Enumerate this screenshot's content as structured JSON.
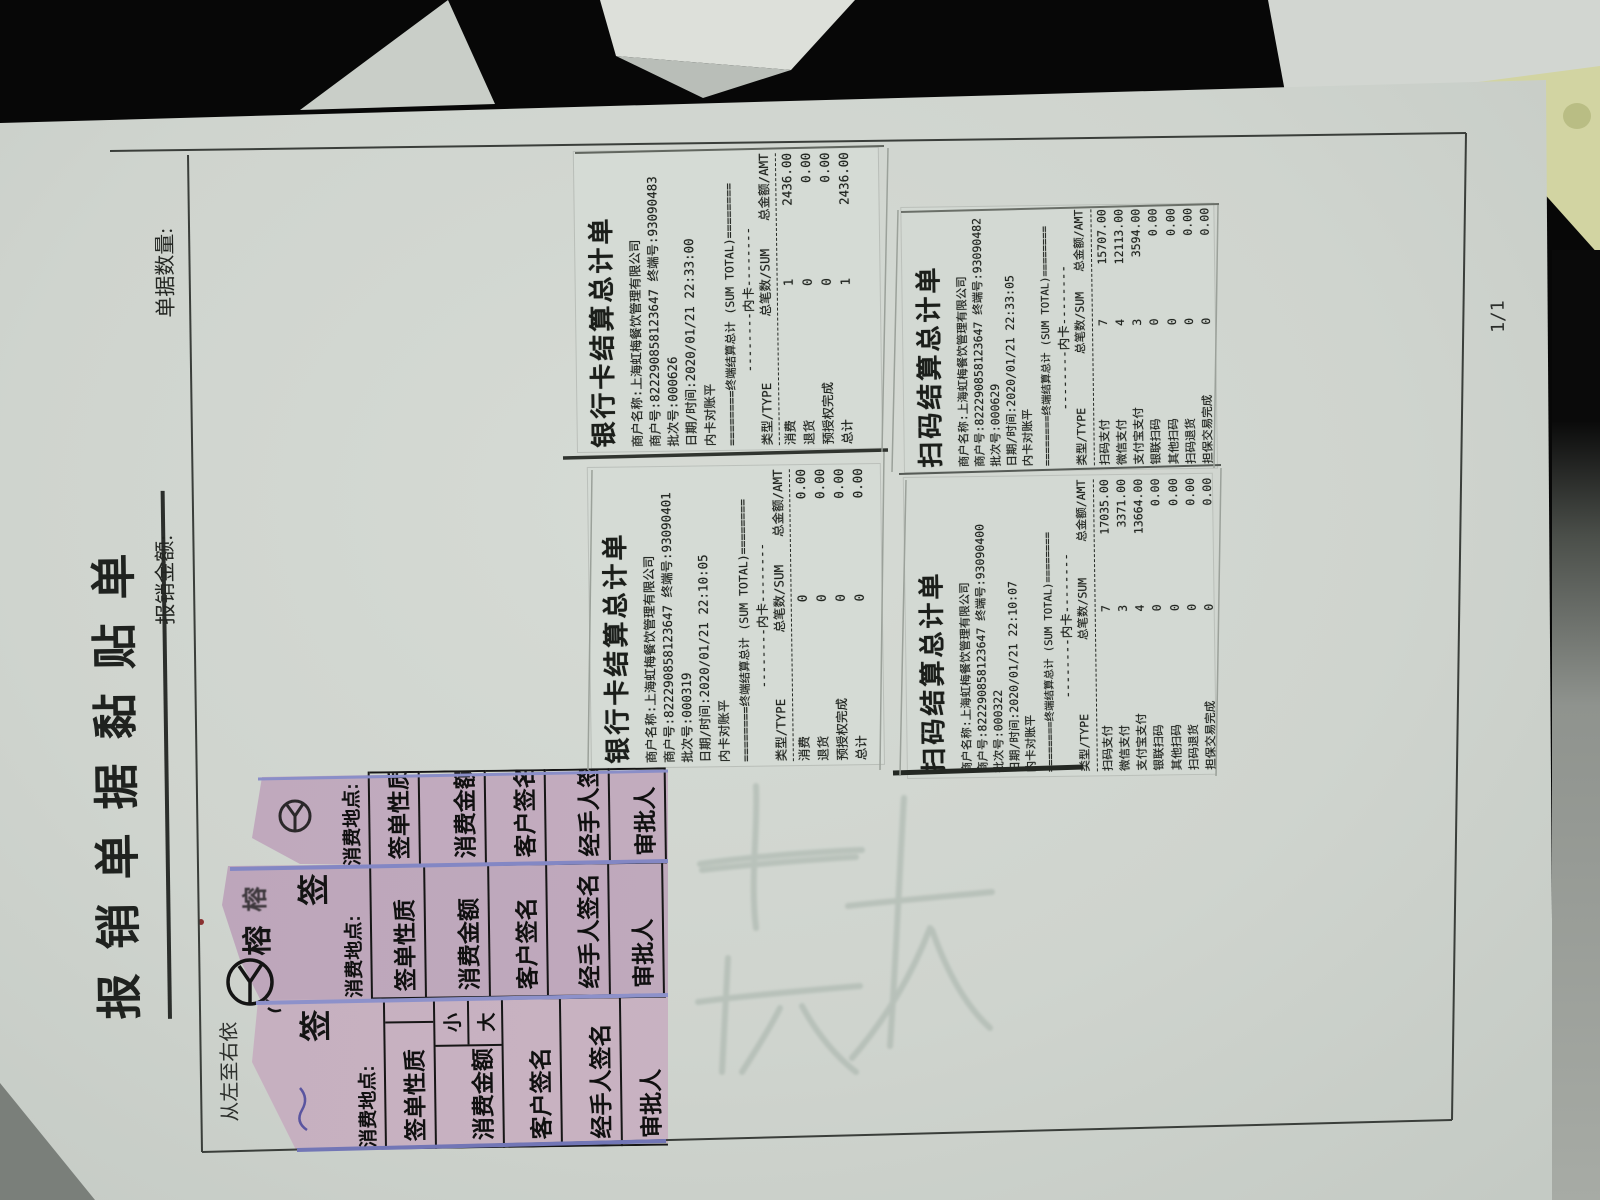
{
  "form": {
    "title": "报销单据黏贴单",
    "amount_label": "报销金额:",
    "count_label": "单据数量:",
    "page_indicator": "1/1",
    "left_instruction": "从左至右依"
  },
  "receipts": {
    "bank_card_1": {
      "title": "银行卡结算总计单",
      "merchant_name": "商户名称:上海虹梅餐饮管理有限公司",
      "merchant_line": "商户号:822290858123647 终端号:93090483",
      "batch": "批次号:000626",
      "datetime": "日期/时间:2020/01/21 22:33:00",
      "status": "内卡对账平",
      "sum_banner": "========终端结算总计 (SUM TOTAL)========",
      "card_line": "--------内卡--------",
      "columns": [
        "类型/TYPE",
        "总笔数/SUM",
        "总金额/AMT"
      ],
      "rows": [
        [
          "消费",
          "1",
          "2436.00"
        ],
        [
          "退货",
          "0",
          "0.00"
        ],
        [
          "预授权完成",
          "0",
          "0.00"
        ],
        [
          "总计",
          "1",
          "2436.00"
        ]
      ]
    },
    "bank_card_2": {
      "title": "银行卡结算总计单",
      "merchant_name": "商户名称:上海虹梅餐饮管理有限公司",
      "merchant_line": "商户号:822290858123647 终端号:93090401",
      "batch": "批次号:000319",
      "datetime": "日期/时间:2020/01/21 22:10:05",
      "status": "内卡对账平",
      "sum_banner": "========终端结算总计 (SUM TOTAL)========",
      "card_line": "--------内卡--------",
      "columns": [
        "类型/TYPE",
        "总笔数/SUM",
        "总金额/AMT"
      ],
      "rows": [
        [
          "消费",
          "0",
          "0.00"
        ],
        [
          "退货",
          "0",
          "0.00"
        ],
        [
          "预授权完成",
          "0",
          "0.00"
        ],
        [
          "总计",
          "0",
          "0.00"
        ]
      ]
    },
    "qr_1": {
      "title": "扫码结算总计单",
      "merchant_name": "商户名称:上海虹梅餐饮管理有限公司",
      "merchant_line": "商户号:822290858123647 终端号:93090482",
      "batch": "批次号:000629",
      "datetime": "日期/时间:2020/01/21 22:33:05",
      "status": "内卡对账平",
      "sum_banner": "========终端结算总计 (SUM TOTAL)========",
      "card_line": "--------内卡--------",
      "columns": [
        "类型/TYPE",
        "总笔数/SUM",
        "总金额/AMT"
      ],
      "rows": [
        [
          "扫码支付",
          "7",
          "15707.00"
        ],
        [
          "微信支付",
          "4",
          "12113.00"
        ],
        [
          "支付宝支付",
          "3",
          "3594.00"
        ],
        [
          "银联扫码",
          "0",
          "0.00"
        ],
        [
          "其他扫码",
          "0",
          "0.00"
        ],
        [
          "扫码退货",
          "0",
          "0.00"
        ],
        [
          "担保交易完成",
          "0",
          "0.00"
        ],
        [
          "总计",
          "7",
          "15707.00"
        ]
      ]
    },
    "qr_2": {
      "title": "扫码结算总计单",
      "merchant_name": "商户名称:上海虹梅餐饮管理有限公司",
      "merchant_line": "商户号:822290858123647 终端号:93090400",
      "batch": "批次号:000322",
      "datetime": "日期/时间:2020/01/21 22:10:07",
      "status": "内卡对账平",
      "sum_banner": "========终端结算总计 (SUM TOTAL)========",
      "card_line": "--------内卡--------",
      "columns": [
        "类型/TYPE",
        "总笔数/SUM",
        "总金额/AMT"
      ],
      "rows": [
        [
          "扫码支付",
          "7",
          "17035.00"
        ],
        [
          "微信支付",
          "3",
          "3371.00"
        ],
        [
          "支付宝支付",
          "4",
          "13664.00"
        ],
        [
          "银联扫码",
          "0",
          "0.00"
        ],
        [
          "其他扫码",
          "0",
          "0.00"
        ],
        [
          "扫码退货",
          "0",
          "0.00"
        ],
        [
          "担保交易完成",
          "0",
          "0.00"
        ],
        [
          "总计",
          "7",
          "17035.00"
        ]
      ]
    }
  },
  "pink_slip": {
    "location_label": "消费地点:",
    "fields": [
      "签单性质",
      "消费金额",
      "客户签名",
      "经手人签名",
      "审批人"
    ],
    "amount_small": "小",
    "amount_large": "大",
    "title_char": "签",
    "brand_char": "榕"
  },
  "colors": {
    "page": "#cfd4ce",
    "background": "#050505",
    "pink_slip": "#c0a9bd",
    "slip_edge_blue": "#8287c3",
    "corner_sheet_cream": "#d2d4a2",
    "ink": "#20241f"
  }
}
